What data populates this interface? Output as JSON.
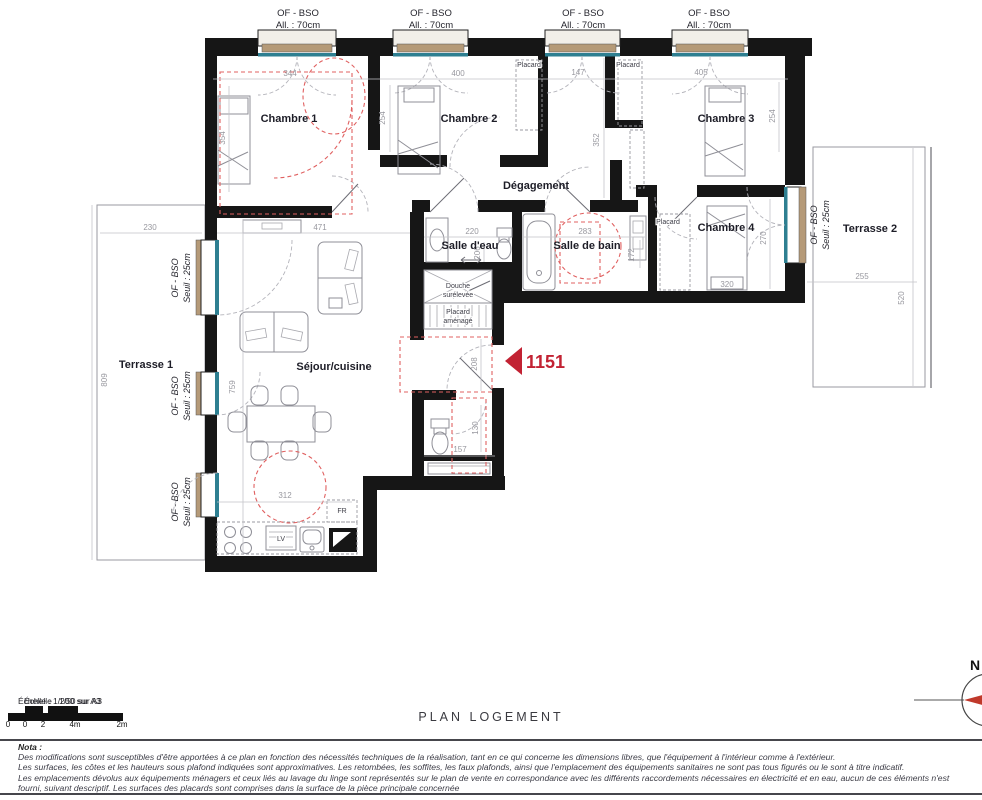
{
  "plan": {
    "top_windows": [
      {
        "line1": "OF - BSO",
        "line2": "All. : 70cm"
      },
      {
        "line1": "OF - BSO",
        "line2": "All. : 70cm"
      },
      {
        "line1": "OF - BSO",
        "line2": "All. : 70cm"
      },
      {
        "line1": "OF - BSO",
        "line2": "All. : 70cm"
      }
    ],
    "side_windows": [
      {
        "line1": "OF - BSO",
        "line2": "Seuil : 25cm"
      },
      {
        "line1": "OF - BSO",
        "line2": "Seuil : 25cm"
      },
      {
        "line1": "OF - BSO",
        "line2": "Seuil : 25cm"
      },
      {
        "line1": "OF - BSO",
        "line2": "Seuil : 25cm"
      }
    ],
    "rooms": {
      "chambre1": "Chambre 1",
      "chambre2": "Chambre 2",
      "chambre3": "Chambre 3",
      "chambre4": "Chambre 4",
      "degagement": "Dégagement",
      "salle_eau": "Salle d'eau",
      "salle_bain": "Salle de bain",
      "sejour": "Séjour/cuisine",
      "terrasse1": "Terrasse 1",
      "terrasse2": "Terrasse 2",
      "placard": "Placard",
      "douche_line1": "Douche",
      "douche_line2": "surélevée",
      "placard_amenage_line1": "Placard",
      "placard_amenage_line2": "aménagé"
    },
    "appliances": {
      "dishwasher": "LV",
      "fridge": "FR"
    },
    "entry_number": "1151",
    "dims": {
      "ch1_width": "344",
      "ch2_width": "400",
      "placard_width": "147",
      "ch3_width": "405",
      "ch1_bed": "354",
      "ch2_height": "254",
      "placard_height": "352",
      "ch3_height": "254",
      "terr1_width": "230",
      "sejour_width": "471",
      "salle_eau_width": "220",
      "salle_bain_width": "283",
      "salle_eau_depth": "206",
      "laundry": "172",
      "ch4_height": "270",
      "ch4_bed": "320",
      "terr2_width": "255",
      "terr2_height": "520",
      "terr1_height": "809",
      "sejour_height": "759",
      "kitchen_width": "312",
      "entry_height": "208",
      "wc_height": "130",
      "wc_width": "157"
    },
    "colors": {
      "teal": "#2e7f91",
      "tan": "#b59a78",
      "red_accent": "#c22233",
      "red_dashed": "#e06060"
    }
  },
  "footer": {
    "scale_text_back": "Échelle : 1/200 sur A3",
    "scale_text_front": "Échelle : 1/50 sur A3",
    "scale_ticks": [
      "0",
      "0",
      "2",
      "4m",
      "2m"
    ],
    "title": "PLAN LOGEMENT",
    "north_letter": "N",
    "nota_title": "Nota :",
    "nota_lines": [
      "Des modifications sont susceptibles d'être apportées à ce plan en fonction des nécessités techniques de la réalisation, tant en ce qui concerne les dimensions libres, que l'équipement à l'intérieur comme à l'extérieur.",
      "Les surfaces, les côtes et les hauteurs sous plafond indiquées sont approximatives. Les retombées, les soffites, les faux plafonds, ainsi que l'emplacement des équipements sanitaires ne sont pas tous figurés ou le sont à titre indicatif.",
      "Les emplacements dévolus aux équipements ménagers et ceux liés au lavage du linge sont représentés sur le plan de vente en correspondance avec les différents raccordements nécessaires en électricité et en eau, aucun de ces éléments n'est",
      "fourni, suivant descriptif. Les surfaces des placards sont comprises dans la surface de la pièce principale concernée"
    ]
  }
}
